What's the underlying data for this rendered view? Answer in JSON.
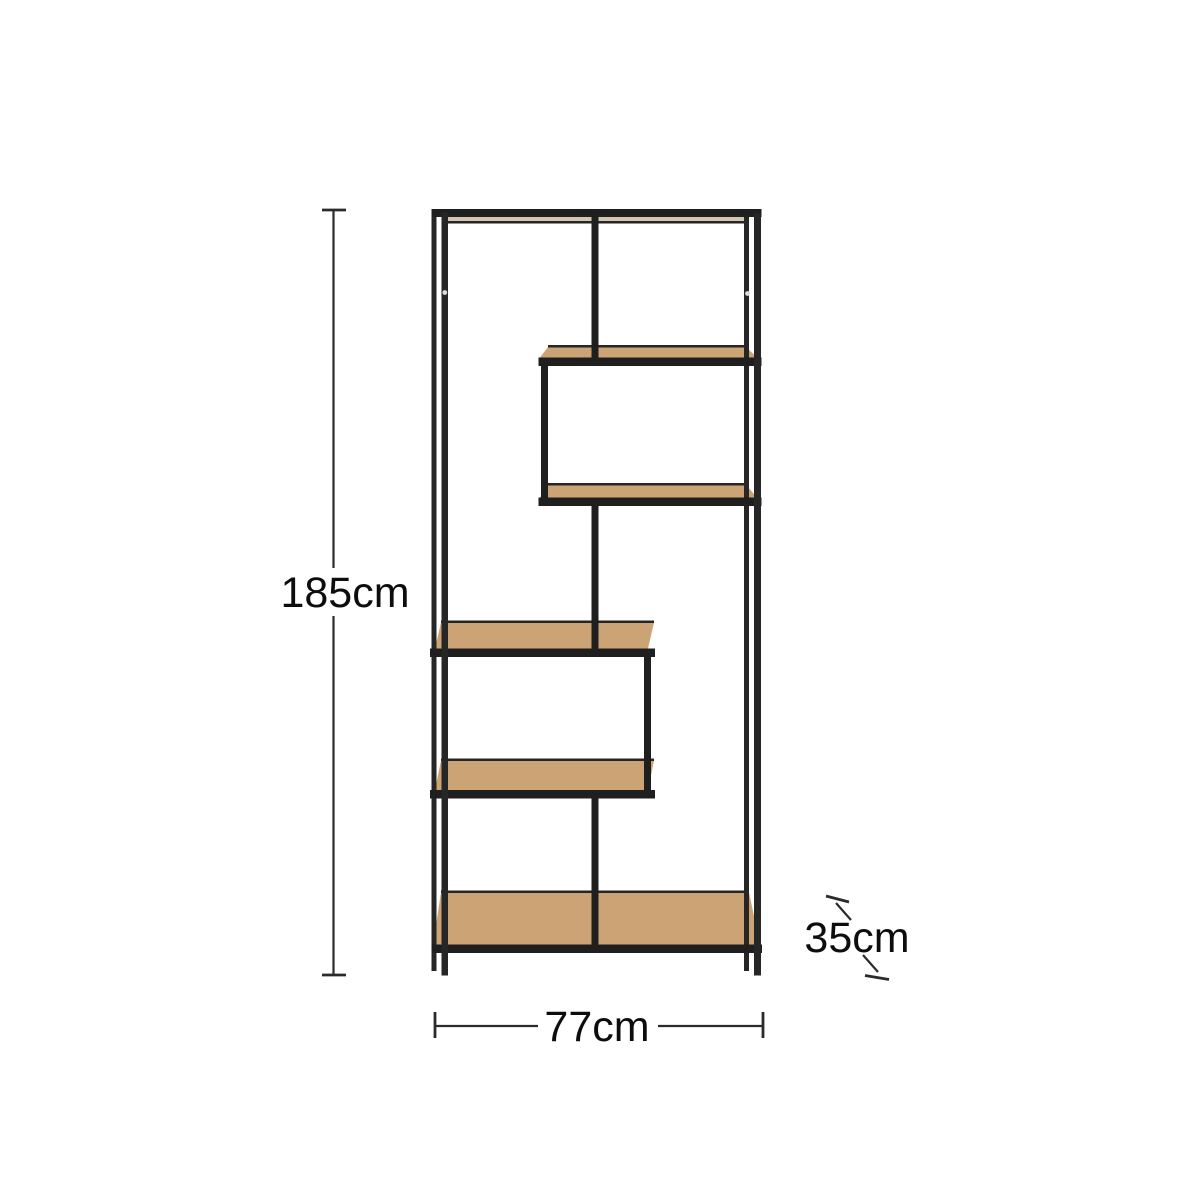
{
  "diagram": {
    "dimensions": {
      "height": {
        "label": "185cm"
      },
      "width": {
        "label": "77cm"
      },
      "depth": {
        "label": "35cm"
      }
    }
  },
  "colors": {
    "background": "#ffffff",
    "frame": "#262626",
    "frame_dark": "#1f1f1f",
    "wood": "#cba374",
    "wood_light": "#d3c7b4",
    "dim_line": "#2b2b2b",
    "text": "#0d0d0d",
    "screw_dot": "#dcdcdc"
  }
}
